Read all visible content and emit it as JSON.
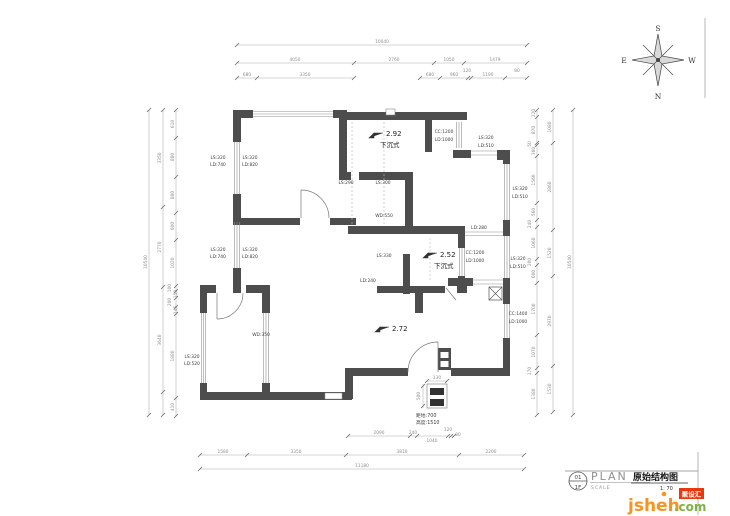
{
  "compass": {
    "n": "N",
    "s": "S",
    "e": "E",
    "w": "W"
  },
  "dims": {
    "top": {
      "total": "10040",
      "row2": [
        "4050",
        "2760",
        "1050",
        "1479"
      ],
      "row3": [
        "680",
        "3350",
        "680",
        "960",
        "120",
        "1190",
        "80"
      ]
    },
    "bottom": {
      "row1": [
        "2090",
        "240",
        "1040",
        "120",
        "80"
      ],
      "row2": [
        "1580",
        "3350",
        "3810",
        "2200"
      ],
      "total": "11180"
    },
    "left": {
      "total": "10540",
      "mid": [
        "3350",
        "2770",
        "3640"
      ],
      "inner": [
        "610",
        "880",
        "800",
        "600",
        "1020",
        "100",
        "150",
        "200",
        "145",
        "1880",
        "410"
      ]
    },
    "right": {
      "total": "10540",
      "mid": [
        "1080",
        "2860",
        "1520",
        "2970",
        "1530"
      ],
      "inner": [
        "220",
        "870",
        "50",
        "360",
        "1560",
        "560",
        "240",
        "1060",
        "200",
        "600",
        "1700",
        "1070",
        "170",
        "1380"
      ]
    }
  },
  "levels": [
    {
      "value": "2.92",
      "note": "下沉式"
    },
    {
      "value": "2.52",
      "note": "下沉式"
    },
    {
      "value": "2.72",
      "note": ""
    }
  ],
  "beams": [
    {
      "l1": "LS:320",
      "l2": "LD:740"
    },
    {
      "l1": "LS:320",
      "l2": "LD:820"
    },
    {
      "l1": "LS:320",
      "l2": "LD:740"
    },
    {
      "l1": "LS:320",
      "l2": "LD:820"
    },
    {
      "l1": "LS:320",
      "l2": "LD:520"
    },
    {
      "l1": "WD:350",
      "l2": ""
    },
    {
      "l1": "LS:290",
      "l2": ""
    },
    {
      "l1": "LS:300",
      "l2": ""
    },
    {
      "l1": "WD:550",
      "l2": ""
    },
    {
      "l1": "CC:1200",
      "l2": "LD:1000"
    },
    {
      "l1": "LS:320",
      "l2": "LD:510"
    },
    {
      "l1": "LS:320",
      "l2": "LD:510"
    },
    {
      "l1": "LD:280",
      "l2": ""
    },
    {
      "l1": "CC:1200",
      "l2": "LD:1000"
    },
    {
      "l1": "LS:320",
      "l2": "LD:510"
    },
    {
      "l1": "CC:1400",
      "l2": "LD:1000"
    },
    {
      "l1": "LS:330",
      "l2": ""
    },
    {
      "l1": "LD:240",
      "l2": ""
    }
  ],
  "fixture": {
    "width": "130",
    "height_dim": "500",
    "line1": "距地:700",
    "line2": "高度:1510"
  },
  "title_block": {
    "sheet_no": "01",
    "floor": "1F",
    "plan": "PLAN",
    "scale_label": "SCALE",
    "drawing_title": "原始结构图",
    "scale_value": "1: 70"
  },
  "logo": {
    "brand": "jsheh",
    "tld": ".com",
    "badge": "聚设汇"
  },
  "colors": {
    "wall": "#4d4d4d",
    "dim_line": "#adadad",
    "accent_orange": "#f7941d",
    "accent_green": "#7cb342",
    "badge_red": "#e8380d"
  }
}
